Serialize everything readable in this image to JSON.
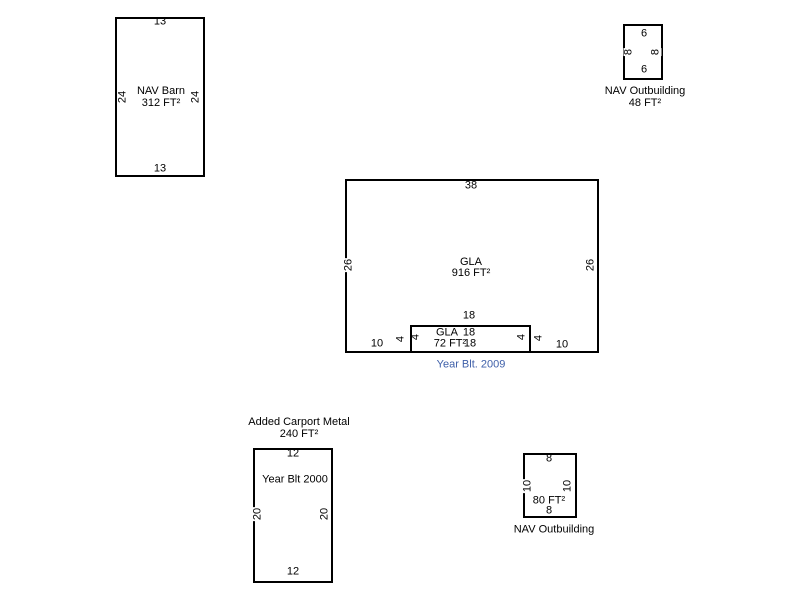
{
  "colors": {
    "line": "#000000",
    "text": "#000000",
    "year_built_blue": "#3E5FA9",
    "background": "#FFFFFF"
  },
  "nav_barn": {
    "name": "NAV Barn",
    "area": "312 FT²",
    "dim_top": "13",
    "dim_bottom": "13",
    "dim_left": "24",
    "dim_right": "24"
  },
  "nav_outbuilding_top": {
    "caption_line1": "NAV Outbuilding",
    "caption_line2": "48 FT²",
    "dim_top": "6",
    "dim_bottom": "6",
    "dim_left": "8",
    "dim_right": "8"
  },
  "gla_main": {
    "name": "GLA",
    "area": "916 FT²",
    "dim_top": "38",
    "dim_left": "26",
    "dim_right": "26",
    "dim_bottom_left": "10",
    "dim_bottom_right": "10",
    "year_built": "Year Blt. 2009"
  },
  "gla_addition": {
    "name": "GLA",
    "area": "72 FT²",
    "dim_top_outer": "18",
    "dim_top_inner": "18",
    "dim_bottom_inner": "18",
    "dim_left_outer": "4",
    "dim_left_inner": "4",
    "dim_right_inner": "4",
    "dim_right_outer": "4"
  },
  "carport": {
    "title_line1": "Added Carport Metal",
    "title_line2": "240 FT²",
    "year_built": "Year Blt 2000",
    "dim_top": "12",
    "dim_bottom": "12",
    "dim_left": "20",
    "dim_right": "20"
  },
  "nav_outbuilding_bottom": {
    "caption": "NAV Outbuilding",
    "area": "80 FT²",
    "dim_top": "8",
    "dim_bottom": "8",
    "dim_left": "10",
    "dim_right": "10"
  }
}
